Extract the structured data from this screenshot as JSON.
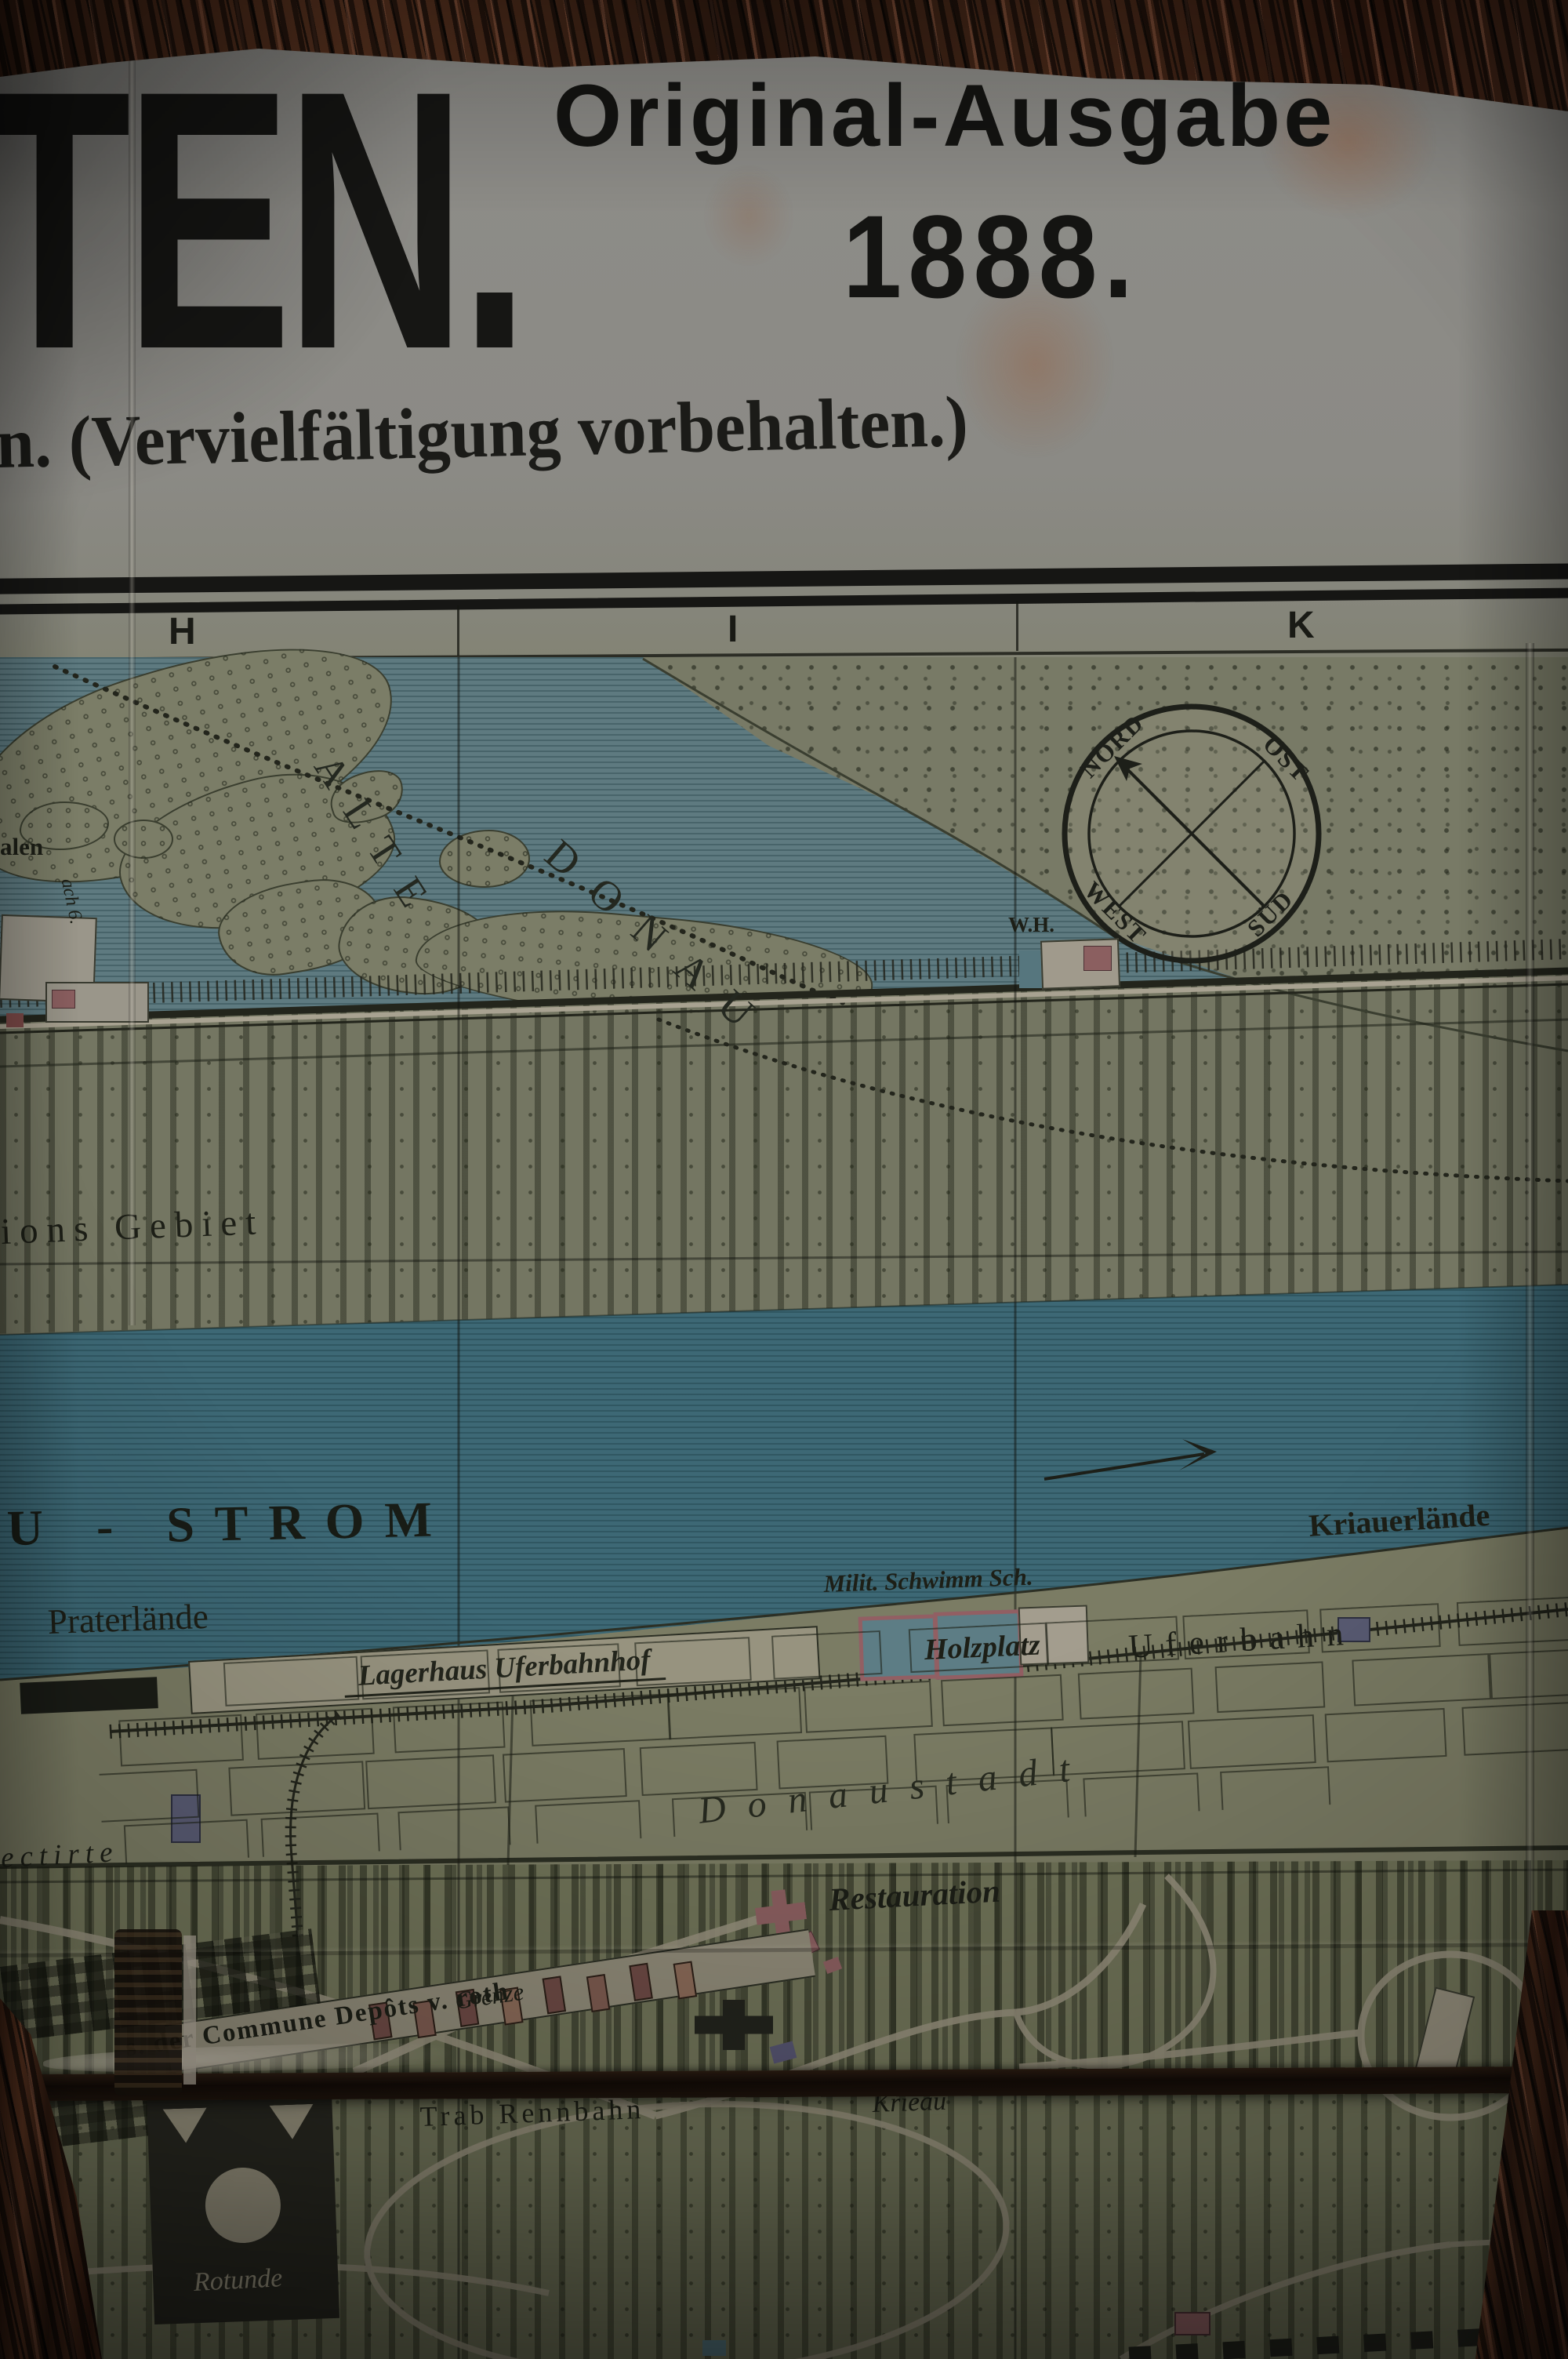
{
  "header": {
    "title_fragment": "TEN.",
    "edition_line": "Original-Ausgabe",
    "year_line": "1888.",
    "rights_line": "n. (Vervielfältigung vorbehalten.)"
  },
  "grid": {
    "columns": [
      "H",
      "I",
      "K"
    ]
  },
  "compass": {
    "north": "NORD",
    "east": "OST",
    "west": "WEST",
    "south": "SÜD"
  },
  "water_labels": {
    "alte": "ALTE",
    "donau": "DONAU",
    "strom_fragment": "U - STROM",
    "kriauerlaende": "Kriauerlände"
  },
  "map_labels": {
    "saeulen_fragment": "alen",
    "rach_fragment": "ach 6.",
    "wh": "W.H.",
    "inundations_fragment": "ions Gebiet",
    "praterlaende": "Praterlände",
    "lagerhaus": "Lagerhaus Uferbahnhof",
    "holzplatz": "Holzplatz",
    "milit_schwimm": "Milit. Schwimm Sch.",
    "uferbahn": "Uferbahn",
    "donaustadt": "Donaustadt",
    "restauration": "Restauration",
    "projectirte_fragment": "ectirte",
    "commune_fragment": "s. der Commune Depôts v. roth",
    "grenze": "Grenze",
    "trab_rennbahn": "Trab Rennbahn",
    "krieau": "Krieau",
    "rotunde": "Rotunde"
  },
  "colors": {
    "wood": "#3a2013",
    "paper_header": "#8e8d89",
    "map_sand": "#787a66",
    "alte_donau_water": "#5e7a80",
    "donau_strom_water": "#3d6875",
    "shore": "#7b7c64",
    "park": "#707358",
    "ink": "#1d1f17",
    "building_pink": "#8b5f60",
    "building_purple": "#5a5c74",
    "fold_shadow": "#170f0a"
  }
}
